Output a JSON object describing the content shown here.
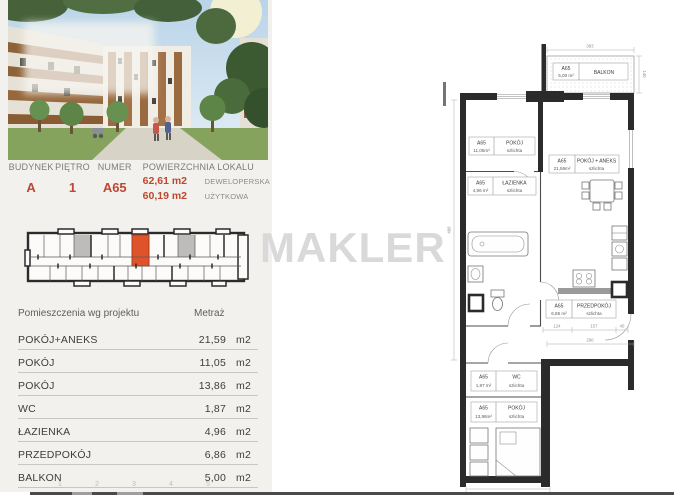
{
  "watermark": "MAKLER",
  "listing": {
    "header": {
      "fields": [
        {
          "label": "BUDYNEK",
          "value": "A"
        },
        {
          "label": "PIĘTRO",
          "value": "1"
        },
        {
          "label": "NUMER",
          "value": "A65"
        }
      ],
      "area_label": "POWIERZCHNIA LOKALU",
      "area_values": [
        {
          "value": "62,61 m2",
          "kind": "DEWELOPERSKA"
        },
        {
          "value": "60,19 m2",
          "kind": "UŻYTKOWA"
        }
      ]
    },
    "rooms": {
      "header_name": "Pomieszczenia wg projektu",
      "header_area": "Metraż",
      "rows": [
        {
          "name": "POKÓJ+ANEKS",
          "area": "21,59",
          "unit": "m2"
        },
        {
          "name": "POKÓJ",
          "area": "11,05",
          "unit": "m2"
        },
        {
          "name": "POKÓJ",
          "area": "13,86",
          "unit": "m2"
        },
        {
          "name": "WC",
          "area": "1,87",
          "unit": "m2"
        },
        {
          "name": "ŁAZIENKA",
          "area": "4,96",
          "unit": "m2"
        },
        {
          "name": "PRZEDPOKÓJ",
          "area": "6,86",
          "unit": "m2"
        },
        {
          "name": "BALKON",
          "area": "5,00",
          "unit": "m2"
        }
      ],
      "pager_marks": [
        "1",
        "2",
        "3",
        "4",
        "5"
      ]
    }
  },
  "floorplan": {
    "unit_code": "A65",
    "labels": {
      "balkon": {
        "code": "A65",
        "area": "5,00 m²",
        "name": "BALKON"
      },
      "pokoj1": {
        "code": "A65",
        "area": "11,05m²",
        "name": "POKÓJ",
        "sub": "szlichta"
      },
      "aneks": {
        "code": "A65",
        "area": "21,59m²",
        "name": "POKÓJ + ANEKS",
        "sub": "szlichta"
      },
      "lazienka": {
        "code": "A65",
        "area": "4,96 m²",
        "name": "ŁAZIENKA",
        "sub": "szlichta"
      },
      "przedpokoj": {
        "code": "A65",
        "area": "6,86 m²",
        "name": "PRZEDPOKÓJ",
        "sub": "szlichta"
      },
      "wc": {
        "code": "A65",
        "area": "1,87 m²",
        "name": "WC",
        "sub": "szlichta"
      },
      "pokoj2": {
        "code": "A65",
        "area": "13,86m²",
        "name": "POKÓJ",
        "sub": "szlichta"
      }
    },
    "dimensions": {
      "top": "383",
      "balcony_side": "140",
      "left": "466",
      "corridor": "290",
      "bottom": "267",
      "hall": [
        "124",
        "157",
        "40"
      ]
    }
  },
  "colors": {
    "accent": "#bf4630",
    "unit_highlight": "#e0522a",
    "unit_muted": "#bdbcba",
    "watermark": "#d9d9d9",
    "panel_bg": "#f2f1ee",
    "wall": "#2b2b2b"
  }
}
